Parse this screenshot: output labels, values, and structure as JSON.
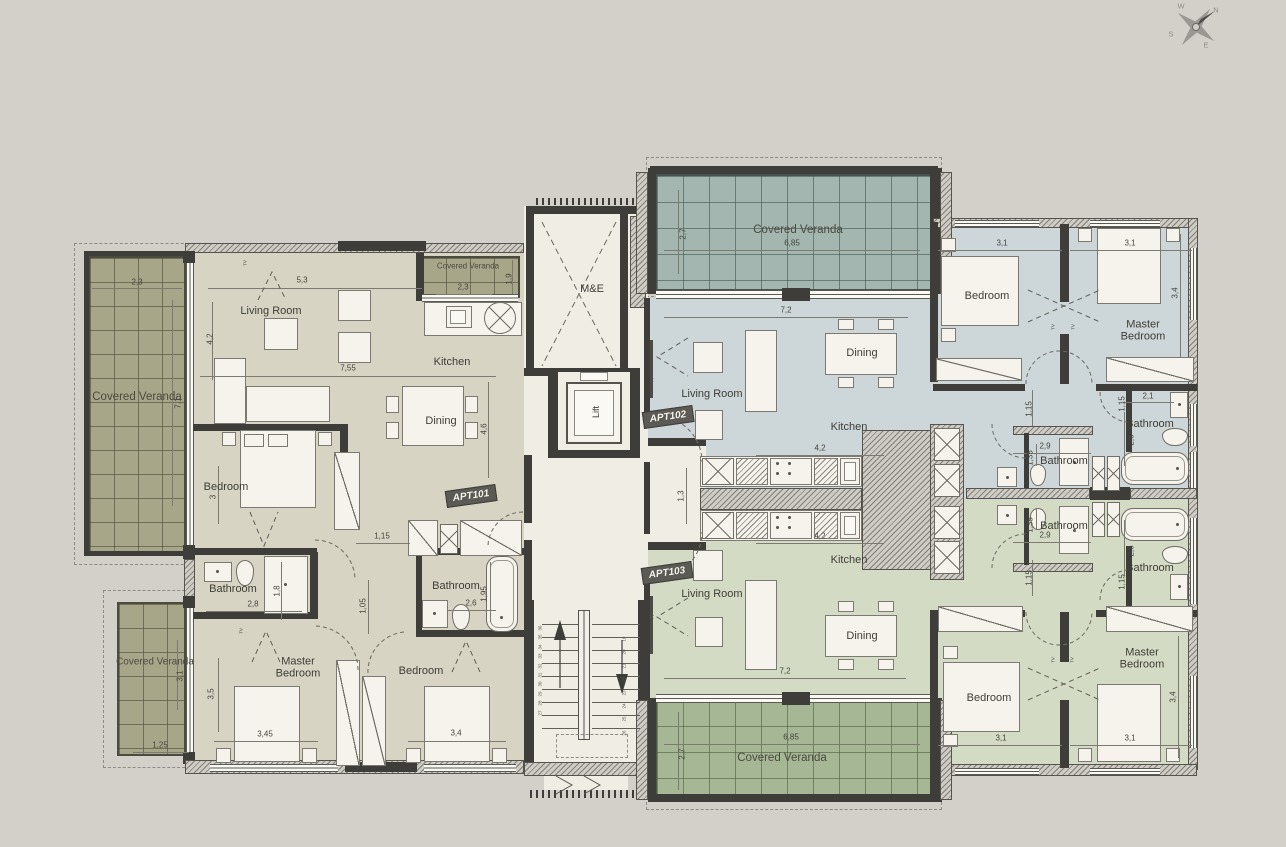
{
  "plan_title": "Apartment floor plan",
  "apartments": [
    {
      "id": "APT101",
      "floor_color": "#d7d4c3"
    },
    {
      "id": "APT102",
      "floor_color": "#cdd6d8"
    },
    {
      "id": "APT103",
      "floor_color": "#d3dbc5"
    }
  ],
  "colors": {
    "background": "#d3d0c9",
    "wall": "#3e3d3a",
    "veranda_olive": "#a8a689",
    "veranda_teal": "#a3b6b0",
    "veranda_green": "#a6b795",
    "fixture": "#f6f3ec"
  },
  "stairs": {
    "left": [
      36,
      35,
      34,
      33,
      32,
      31,
      30,
      29,
      28,
      27
    ],
    "right": [
      19,
      20,
      21,
      22,
      23,
      24,
      25,
      26
    ]
  },
  "labels": [
    {
      "t": "Living Room",
      "x": 271,
      "y": 311,
      "c": "room",
      "n": "apt101-living-room-label"
    },
    {
      "t": "Kitchen",
      "x": 452,
      "y": 362,
      "c": "room",
      "n": "apt101-kitchen-label"
    },
    {
      "t": "Dining",
      "x": 441,
      "y": 421,
      "c": "room",
      "n": "apt101-dining-label"
    },
    {
      "t": "Bedroom",
      "x": 226,
      "y": 487,
      "c": "room",
      "n": "apt101-bedroom-label"
    },
    {
      "t": "Bathroom",
      "x": 233,
      "y": 589,
      "c": "room",
      "n": "apt101-bathroom1-label"
    },
    {
      "t": "Bathroom",
      "x": 456,
      "y": 586,
      "c": "room",
      "n": "apt101-bathroom2-label"
    },
    {
      "t": "Master Bedroom",
      "x": 298,
      "y": 668,
      "c": "room2",
      "n": "apt101-master-bedroom-label"
    },
    {
      "t": "Bedroom",
      "x": 421,
      "y": 671,
      "c": "room",
      "n": "apt101-bedroom2-label"
    },
    {
      "t": "Living Room",
      "x": 712,
      "y": 394,
      "c": "room",
      "n": "apt102-living-room-label"
    },
    {
      "t": "Dining",
      "x": 862,
      "y": 353,
      "c": "room",
      "n": "apt102-dining-label"
    },
    {
      "t": "Kitchen",
      "x": 849,
      "y": 427,
      "c": "room",
      "n": "apt102-kitchen-label"
    },
    {
      "t": "Bedroom",
      "x": 987,
      "y": 296,
      "c": "room",
      "n": "apt102-bedroom-label"
    },
    {
      "t": "Master Bedroom",
      "x": 1143,
      "y": 331,
      "c": "room2",
      "n": "apt102-master-bedroom-label"
    },
    {
      "t": "Bathroom",
      "x": 1064,
      "y": 461,
      "c": "room",
      "n": "apt102-bathroom1-label"
    },
    {
      "t": "Bathroom",
      "x": 1150,
      "y": 424,
      "c": "room",
      "n": "apt102-bathroom2-label"
    },
    {
      "t": "Living Room",
      "x": 712,
      "y": 594,
      "c": "room",
      "n": "apt103-living-room-label"
    },
    {
      "t": "Kitchen",
      "x": 849,
      "y": 560,
      "c": "room",
      "n": "apt103-kitchen-label"
    },
    {
      "t": "Dining",
      "x": 862,
      "y": 636,
      "c": "room",
      "n": "apt103-dining-label"
    },
    {
      "t": "Bedroom",
      "x": 989,
      "y": 698,
      "c": "room",
      "n": "apt103-bedroom-label"
    },
    {
      "t": "Master Bedroom",
      "x": 1142,
      "y": 659,
      "c": "room2",
      "n": "apt103-master-bedroom-label"
    },
    {
      "t": "Bathroom",
      "x": 1064,
      "y": 526,
      "c": "room",
      "n": "apt103-bathroom1-label"
    },
    {
      "t": "Bathroom",
      "x": 1150,
      "y": 568,
      "c": "room",
      "n": "apt103-bathroom2-label"
    },
    {
      "t": "M&E",
      "x": 592,
      "y": 289,
      "c": "room",
      "n": "me-room-label"
    },
    {
      "t": "Lift",
      "x": 596,
      "y": 412,
      "c": "roomv",
      "n": "lift-label"
    },
    {
      "t": "Covered Veranda",
      "x": 137,
      "y": 397,
      "c": "ver",
      "n": "veranda-left-label"
    },
    {
      "t": "Covered Veranda",
      "x": 468,
      "y": 266,
      "c": "verS",
      "n": "veranda-small-label"
    },
    {
      "t": "Covered Veranda",
      "x": 798,
      "y": 230,
      "c": "ver",
      "n": "veranda-top-right-label"
    },
    {
      "t": "Covered Veranda",
      "x": 155,
      "y": 662,
      "c": "verM",
      "n": "veranda-bottom-left-label"
    },
    {
      "t": "Covered Veranda",
      "x": 782,
      "y": 758,
      "c": "ver",
      "n": "veranda-bottom-right-label"
    },
    {
      "t": "APT101",
      "x": 471,
      "y": 496,
      "c": "badge",
      "n": "apt101-badge"
    },
    {
      "t": "APT102",
      "x": 668,
      "y": 417,
      "c": "badge",
      "n": "apt102-badge"
    },
    {
      "t": "APT103",
      "x": 667,
      "y": 573,
      "c": "badge",
      "n": "apt103-badge"
    },
    {
      "t": "2,3",
      "x": 137,
      "y": 282,
      "c": "dim"
    },
    {
      "t": "5,3",
      "x": 302,
      "y": 280,
      "c": "dim"
    },
    {
      "t": "7,55",
      "x": 348,
      "y": 368,
      "c": "dim"
    },
    {
      "t": "2,3",
      "x": 463,
      "y": 287,
      "c": "dim"
    },
    {
      "t": "1,15",
      "x": 382,
      "y": 536,
      "c": "dim"
    },
    {
      "t": "2,8",
      "x": 253,
      "y": 604,
      "c": "dim"
    },
    {
      "t": "2,6",
      "x": 471,
      "y": 603,
      "c": "dim"
    },
    {
      "t": "3,45",
      "x": 265,
      "y": 734,
      "c": "dim"
    },
    {
      "t": "3,4",
      "x": 456,
      "y": 733,
      "c": "dim"
    },
    {
      "t": "1,25",
      "x": 160,
      "y": 745,
      "c": "dim"
    },
    {
      "t": "6,85",
      "x": 792,
      "y": 243,
      "c": "dim"
    },
    {
      "t": "7,2",
      "x": 786,
      "y": 310,
      "c": "dim"
    },
    {
      "t": "4,2",
      "x": 820,
      "y": 448,
      "c": "dim"
    },
    {
      "t": "4,2",
      "x": 820,
      "y": 536,
      "c": "dim"
    },
    {
      "t": "7,2",
      "x": 785,
      "y": 671,
      "c": "dim"
    },
    {
      "t": "6,85",
      "x": 791,
      "y": 737,
      "c": "dim"
    },
    {
      "t": "3,1",
      "x": 1002,
      "y": 243,
      "c": "dim"
    },
    {
      "t": "3,1",
      "x": 1130,
      "y": 243,
      "c": "dim"
    },
    {
      "t": "2,1",
      "x": 1148,
      "y": 396,
      "c": "dim"
    },
    {
      "t": "2,9",
      "x": 1045,
      "y": 446,
      "c": "dim"
    },
    {
      "t": "2,9",
      "x": 1045,
      "y": 535,
      "c": "dim"
    },
    {
      "t": "3,1",
      "x": 1001,
      "y": 738,
      "c": "dim"
    },
    {
      "t": "3,1",
      "x": 1130,
      "y": 738,
      "c": "dim"
    },
    {
      "t": "7,1",
      "x": 178,
      "y": 403,
      "c": "dimv"
    },
    {
      "t": "4,2",
      "x": 210,
      "y": 339,
      "c": "dimv"
    },
    {
      "t": "4,6",
      "x": 484,
      "y": 429,
      "c": "dimv"
    },
    {
      "t": "1,9",
      "x": 509,
      "y": 279,
      "c": "dimv"
    },
    {
      "t": "3",
      "x": 213,
      "y": 497,
      "c": "dimv"
    },
    {
      "t": "1,8",
      "x": 277,
      "y": 591,
      "c": "dimv"
    },
    {
      "t": "1,05",
      "x": 363,
      "y": 606,
      "c": "dimv"
    },
    {
      "t": "1,95",
      "x": 484,
      "y": 594,
      "c": "dimv"
    },
    {
      "t": "3,5",
      "x": 211,
      "y": 694,
      "c": "dimv"
    },
    {
      "t": "3,1",
      "x": 180,
      "y": 676,
      "c": "dimv"
    },
    {
      "t": "2,7",
      "x": 683,
      "y": 234,
      "c": "dimv"
    },
    {
      "t": "2,7",
      "x": 682,
      "y": 754,
      "c": "dimv"
    },
    {
      "t": "1,3",
      "x": 681,
      "y": 496,
      "c": "dimv"
    },
    {
      "t": "3,4",
      "x": 1175,
      "y": 293,
      "c": "dimv"
    },
    {
      "t": "3,4",
      "x": 1173,
      "y": 697,
      "c": "dimv"
    },
    {
      "t": "2,6",
      "x": 1131,
      "y": 440,
      "c": "dimv"
    },
    {
      "t": "2,6",
      "x": 1131,
      "y": 551,
      "c": "dimv"
    },
    {
      "t": "1,35",
      "x": 1030,
      "y": 458,
      "c": "dimv"
    },
    {
      "t": "1,35",
      "x": 1030,
      "y": 525,
      "c": "dimv"
    },
    {
      "t": "1,15",
      "x": 1029,
      "y": 409,
      "c": "dimv"
    },
    {
      "t": "1,15",
      "x": 1029,
      "y": 578,
      "c": "dimv"
    },
    {
      "t": "1,15",
      "x": 1122,
      "y": 404,
      "c": "dimv"
    },
    {
      "t": "1,15",
      "x": 1122,
      "y": 582,
      "c": "dimv"
    },
    {
      "t": "W",
      "x": 1181,
      "y": 6,
      "c": "comp",
      "n": "compass-w"
    },
    {
      "t": "N",
      "x": 1216,
      "y": 10,
      "c": "comp",
      "n": "compass-n"
    },
    {
      "t": "S",
      "x": 1171,
      "y": 34,
      "c": "comp",
      "n": "compass-s"
    },
    {
      "t": "E",
      "x": 1206,
      "y": 45,
      "c": "comp",
      "n": "compass-e"
    },
    {
      "t": "TV",
      "x": 245,
      "y": 263,
      "c": "tv"
    },
    {
      "t": "TV",
      "x": 241,
      "y": 631,
      "c": "tv"
    },
    {
      "t": "TV",
      "x": 652,
      "y": 380,
      "c": "tv"
    },
    {
      "t": "TV",
      "x": 652,
      "y": 617,
      "c": "tv"
    },
    {
      "t": "TV",
      "x": 1053,
      "y": 327,
      "c": "tv"
    },
    {
      "t": "TV",
      "x": 1073,
      "y": 327,
      "c": "tv"
    },
    {
      "t": "TV",
      "x": 1053,
      "y": 660,
      "c": "tv"
    },
    {
      "t": "TV",
      "x": 1072,
      "y": 660,
      "c": "tv"
    }
  ]
}
